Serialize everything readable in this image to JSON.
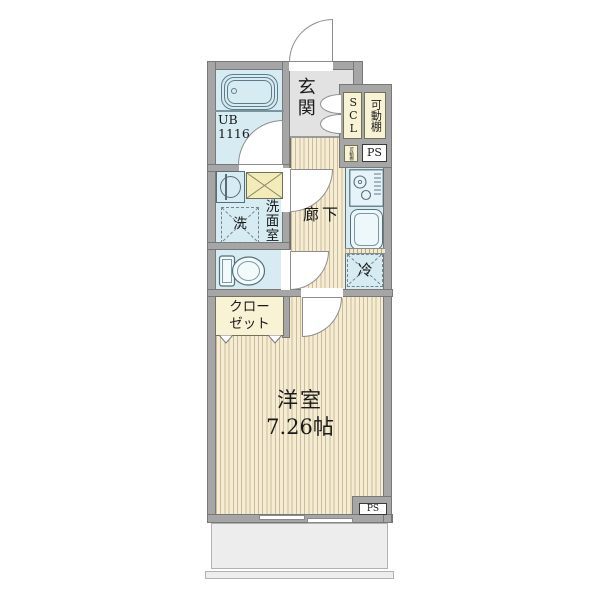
{
  "plan": {
    "entrance_label": "玄関",
    "hallway_label": "廊下",
    "unit_bath": {
      "line1": "UB",
      "line2": "1116"
    },
    "washroom_label": "洗面室",
    "washer_label": "洗",
    "refrigerator_label": "冷",
    "scl_label": "SCL",
    "movable_shelf_label": "可動棚",
    "movable_shelf_small_label": "可動棚",
    "pipe_space_upper_label": "PS",
    "pipe_space_lower_label": "PS",
    "closet": {
      "line1": "クロー",
      "line2": "ゼット"
    },
    "main_room": {
      "name": "洋室",
      "size": "7.26帖"
    }
  },
  "colors": {
    "wall_gray": "#a6a6a6",
    "wood_floor_bg": "#f4ecd4",
    "wood_floor_stripe": "#ccbb93",
    "wet_area_blue": "#d6ecf2",
    "storage_cream": "#f8f3d4",
    "counter_yellow": "#f3ecb9",
    "entrance_gray": "#e2e2e2",
    "balcony_gray": "#ededed"
  }
}
